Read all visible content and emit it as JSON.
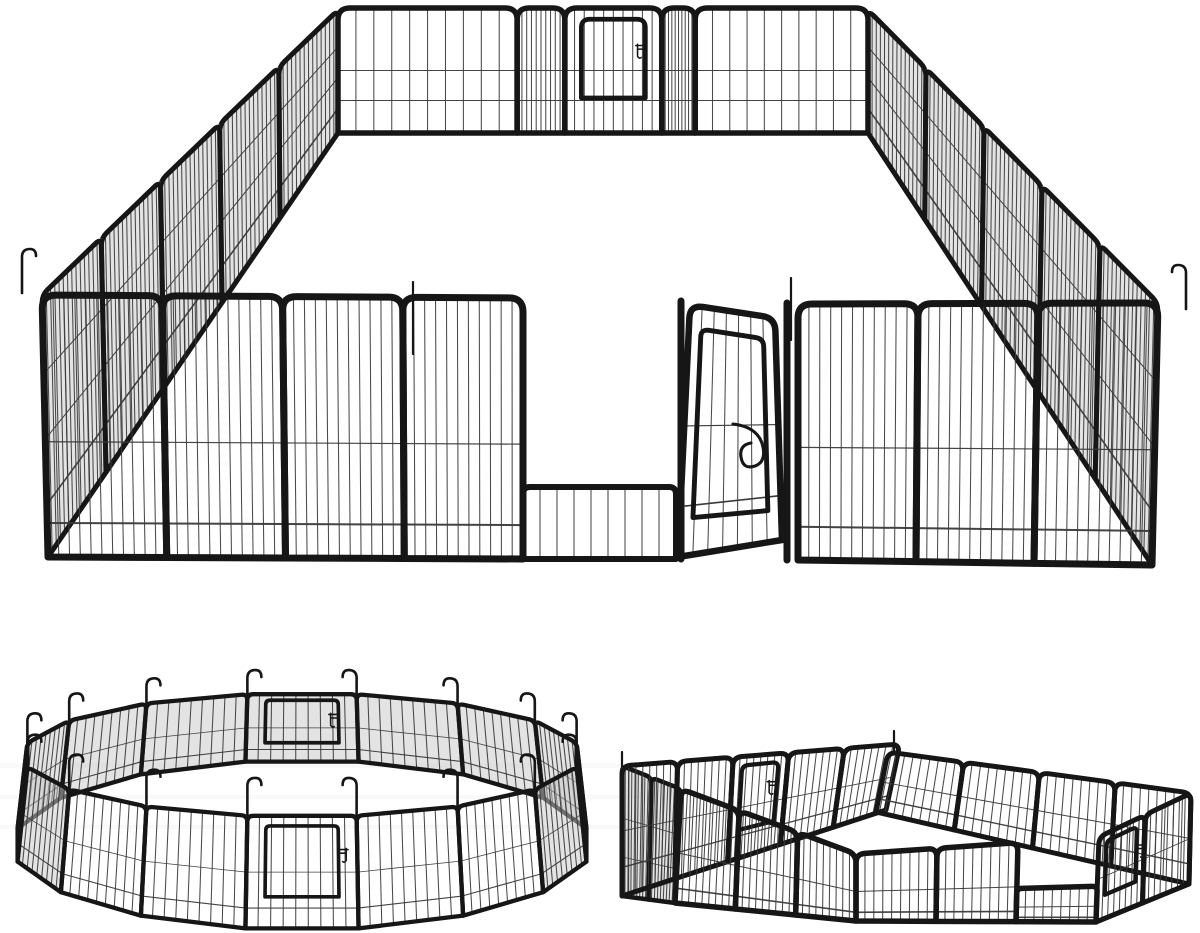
{
  "meta": {
    "title": "Heavy-duty black metal pet exercise playpen shown in three panel configurations",
    "background": "#ffffff"
  },
  "palette": {
    "frame": "#161616",
    "wire": "#3a3a3a",
    "hatch": "#c7c7c7",
    "band": "#9a9a9a"
  },
  "figures": {
    "rect": {
      "aria": "Large rectangular playpen seen in perspective with a walk-through door standing open at the front",
      "walls": [
        {
          "name": "left-side-wall",
          "top": [
            [
              338,
              10
            ],
            [
              42,
              295
            ]
          ],
          "bot": [
            [
              338,
              133
            ],
            [
              48,
              557
            ]
          ],
          "panels": 5,
          "wires": 14,
          "frame": 5,
          "r": 8,
          "hatch": true,
          "hrails": [
            [
              0.3,
              1
            ],
            [
              0.55,
              1
            ],
            [
              0.8,
              1.6
            ]
          ]
        },
        {
          "name": "right-side-wall",
          "top": [
            [
              868,
              10
            ],
            [
              1158,
              303
            ]
          ],
          "bot": [
            [
              868,
              133
            ],
            [
              1152,
              565
            ]
          ],
          "panels": 5,
          "wires": 14,
          "frame": 5,
          "r": 8,
          "hatch": true,
          "hrails": [
            [
              0.3,
              1
            ],
            [
              0.55,
              1
            ],
            [
              0.8,
              1.6
            ]
          ]
        },
        {
          "name": "back-wall",
          "top": [
            [
              338,
              8
            ],
            [
              868,
              8
            ]
          ],
          "bot": [
            [
              338,
              133
            ],
            [
              868,
              133
            ]
          ],
          "panels": 5,
          "splits": [
            0,
            0.338,
            0.428,
            0.611,
            0.674,
            1
          ],
          "wires": 10,
          "frame": 5.5,
          "r": 12,
          "hrails": [
            [
              0.5,
              1
            ],
            [
              0.74,
              1
            ]
          ],
          "door": {
            "panel": 2,
            "side": "right"
          }
        },
        {
          "name": "front-wall-left",
          "top": [
            [
              42,
              295
            ],
            [
              523,
              298
            ]
          ],
          "bot": [
            [
              48,
              557
            ],
            [
              523,
              559
            ]
          ],
          "panels": 4,
          "wires": 11,
          "frame": 7,
          "r": 14,
          "hrails": [
            [
              0.56,
              1.2
            ],
            [
              0.87,
              2
            ]
          ]
        },
        {
          "name": "door-threshold",
          "top": [
            [
              523,
              487
            ],
            [
              676,
              487
            ]
          ],
          "bot": [
            [
              523,
              559
            ],
            [
              676,
              559
            ]
          ],
          "panels": 1,
          "wires": 9,
          "frame": 6,
          "r": 7,
          "hrails": []
        },
        {
          "name": "door-post-left",
          "bar": [
            [
              681,
              301
            ],
            [
              681,
              559
            ]
          ],
          "frame": 7
        },
        {
          "name": "door-hinge-post",
          "bar": [
            [
              787,
              303
            ],
            [
              787,
              560
            ]
          ],
          "frame": 7
        },
        {
          "name": "front-wall-right",
          "top": [
            [
              798,
              304
            ],
            [
              1158,
              303
            ]
          ],
          "bot": [
            [
              798,
              560
            ],
            [
              1152,
              565
            ]
          ],
          "panels": 3,
          "wires": 11,
          "frame": 7,
          "r": 14,
          "hrails": [
            [
              0.56,
              1.2
            ],
            [
              0.87,
              2
            ]
          ]
        }
      ],
      "open_door": {
        "quad": [
          [
            690,
            305
          ],
          [
            775,
            318
          ],
          [
            782,
            540
          ],
          [
            678,
            557
          ]
        ],
        "wires": 7,
        "frame": 6.5,
        "r": 13,
        "hrails": [
          [
            0.48,
            1.2
          ],
          [
            0.8,
            1.6
          ]
        ],
        "latch_at": [
          733,
          424
        ]
      },
      "hooks": [
        {
          "x": 22,
          "y": 293,
          "len": 36,
          "dir": -1
        },
        {
          "x": 1186,
          "y": 309,
          "len": 36,
          "dir": 1
        }
      ],
      "pins": [
        {
          "x": 413,
          "y": 282,
          "len": 72
        },
        {
          "x": 791,
          "y": 278,
          "len": 62
        }
      ]
    },
    "circle": {
      "aria": "Sixteen playpen panels connected in a circle with ground anchor hooks at every joint",
      "top_rim": {
        "cx": 302,
        "cy": 755,
        "rx": 280,
        "ry": 62
      },
      "bot_rim": {
        "cx": 302,
        "cy": 845,
        "rx": 290,
        "ry": 85
      },
      "segments": 16,
      "angle_offset": 11.25,
      "front_door": 3,
      "back_door": 11,
      "panel": {
        "wires": 9,
        "frame": 4.3,
        "r": 6,
        "hrails": [
          [
            0.5,
            0.8
          ],
          [
            0.82,
            1.1
          ]
        ]
      },
      "hooks": {
        "base": 18,
        "extra": 14
      }
    },
    "zigzag": {
      "aria": "Two rectangular playpens joined at a corner in a zig-zag layout with a door at the right end",
      "walls": [
        {
          "name": "left-end-wall",
          "top": [
            [
              622,
              766
            ],
            [
              681,
              789
            ]
          ],
          "bot": [
            [
              622,
              896
            ],
            [
              675,
              903
            ]
          ],
          "panels": 2,
          "wires": 9,
          "frame": 4.5,
          "r": 6,
          "hatch": true,
          "hrails": [
            [
              0.4,
              0.8
            ],
            [
              0.7,
              0.8
            ]
          ]
        },
        {
          "name": "left-back-wall",
          "top": [
            [
              622,
              766
            ],
            [
              900,
              744
            ]
          ],
          "bot": [
            [
              622,
              896
            ],
            [
              886,
              810
            ]
          ],
          "panels": 5,
          "wires": 8,
          "frame": 5,
          "r": 9,
          "hrails": [
            [
              0.5,
              0.9
            ],
            [
              0.78,
              1.4
            ]
          ],
          "door": {
            "panel": 2,
            "side": "right"
          }
        },
        {
          "name": "right-back-wall",
          "top": [
            [
              888,
              752
            ],
            [
              1191,
              793
            ]
          ],
          "bot": [
            [
              876,
              812
            ],
            [
              1189,
              884
            ]
          ],
          "panels": 4,
          "wires": 9,
          "frame": 5,
          "r": 9,
          "hrails": [
            [
              0.5,
              0.9
            ],
            [
              0.78,
              1.4
            ]
          ]
        },
        {
          "name": "right-end-wall",
          "top": [
            [
              1191,
              793
            ],
            [
              1099,
              837
            ]
          ],
          "bot": [
            [
              1189,
              884
            ],
            [
              1096,
              922
            ]
          ],
          "panels": 2,
          "wires": 8,
          "frame": 5,
          "r": 8,
          "hrails": [
            [
              0.5,
              0.9
            ]
          ],
          "door": {
            "panel": 1,
            "side": "left"
          }
        },
        {
          "name": "left-front-wall",
          "top": [
            [
              681,
              789
            ],
            [
              856,
              854
            ]
          ],
          "bot": [
            [
              675,
              903
            ],
            [
              856,
              921
            ]
          ],
          "panels": 3,
          "wires": 9,
          "frame": 5.5,
          "r": 9,
          "hrails": [
            [
              0.56,
              1
            ],
            [
              0.87,
              1.6
            ]
          ]
        },
        {
          "name": "right-front-wall",
          "top": [
            [
              856,
              854
            ],
            [
              1099,
              837
            ]
          ],
          "bot": [
            [
              856,
              921
            ],
            [
              1096,
              922
            ]
          ],
          "panels": 3,
          "wires": 9,
          "frame": 5.5,
          "r": 9,
          "low_panel": 2,
          "hrails": [
            [
              0.56,
              1
            ],
            [
              0.87,
              1.6
            ]
          ]
        }
      ],
      "pins": [
        {
          "x": 622,
          "y": 752,
          "len": 22
        },
        {
          "x": 894,
          "y": 731,
          "len": 22
        }
      ]
    }
  },
  "bands": [
    {
      "x": 0,
      "y": 763,
      "w": 640,
      "h": 5
    },
    {
      "x": 0,
      "y": 795,
      "w": 640,
      "h": 4
    },
    {
      "x": 0,
      "y": 825,
      "w": 620,
      "h": 4
    }
  ]
}
